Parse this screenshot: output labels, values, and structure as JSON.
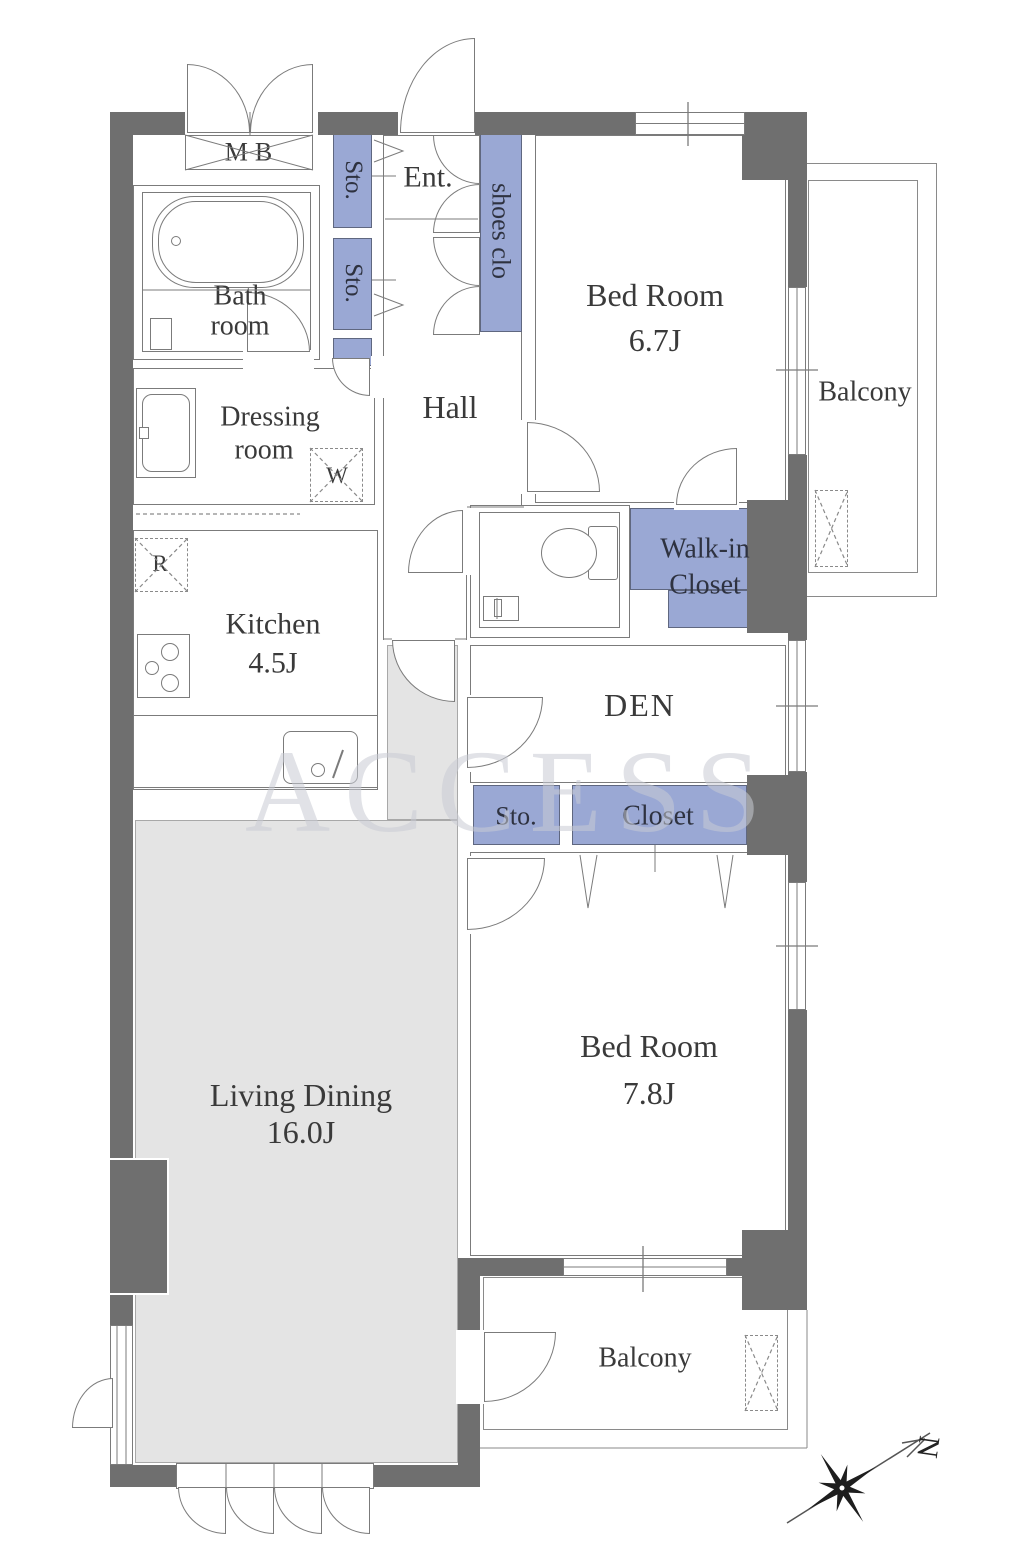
{
  "plan": {
    "rooms": {
      "entrance": "Ent.",
      "hall": "Hall",
      "bathroom": [
        "Bath",
        "room"
      ],
      "dressing_room": [
        "Dressing",
        "room"
      ],
      "kitchen": {
        "name": "Kitchen",
        "area": "4.5J"
      },
      "bedroom_1": {
        "name": "Bed Room",
        "area": "6.7J"
      },
      "bedroom_2": {
        "name": "Bed Room",
        "area": "7.8J"
      },
      "living_dining": {
        "name": "Living Dining",
        "area": "16.0J"
      },
      "den": "DEN",
      "walk_in_closet": [
        "Walk-in",
        "Closet"
      ],
      "balcony_east": "Balcony",
      "balcony_south": "Balcony"
    },
    "storage": {
      "storage_short": "Sto.",
      "shoes_closet": "shoes clo",
      "closet": "Closet"
    },
    "fixtures": {
      "meter_box": "MB",
      "washing_machine": "W",
      "refrigerator": "R"
    },
    "compass": {
      "north": "N"
    },
    "watermark": "ACCESS",
    "colors": {
      "wall": "#6f6f6f",
      "closet_fill": "#9aa8d4",
      "ld_floor": "#e4e4e4",
      "outline": "#7b7b7b"
    }
  }
}
